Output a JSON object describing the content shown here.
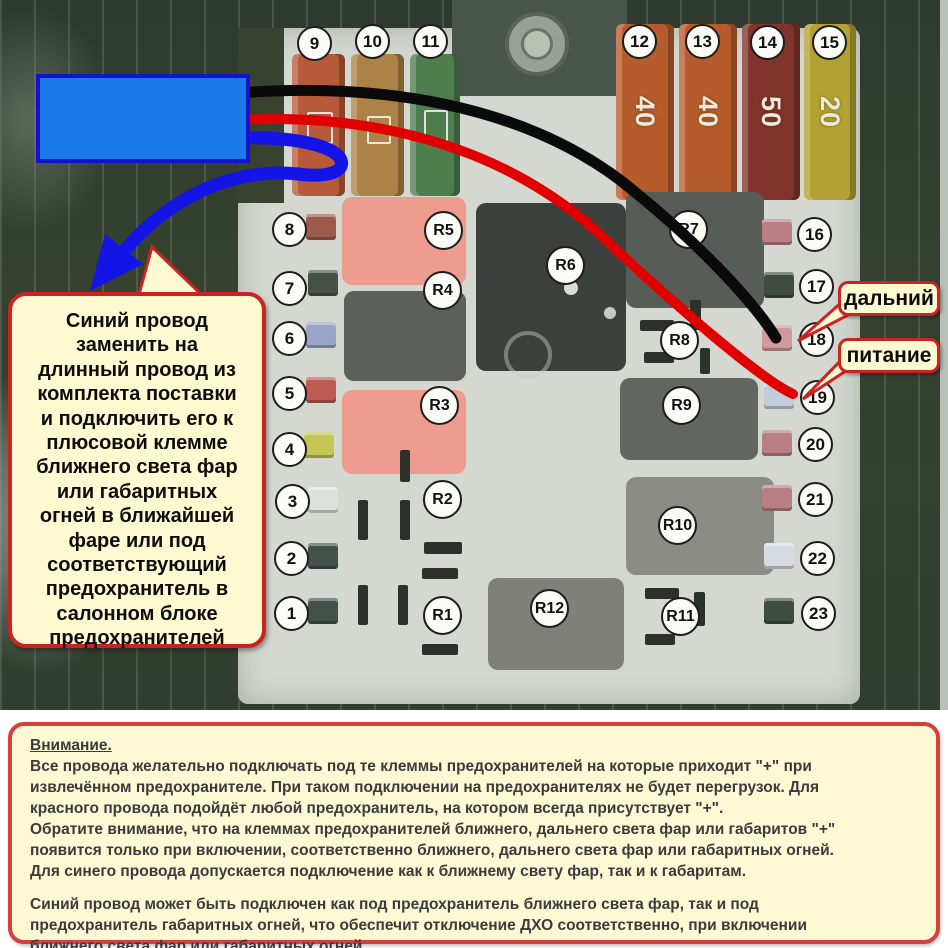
{
  "colors": {
    "wire_black": "#0a0a0a",
    "wire_red": "#e10000",
    "wire_blue": "#1414e6",
    "callout_bg": "#fdf9d0",
    "callout_border": "#cc2222",
    "blue_box_fill": "#1b79e8",
    "blue_box_border": "#1313cf"
  },
  "fusebox": {
    "fuse_numbers": [
      "1",
      "2",
      "3",
      "4",
      "5",
      "6",
      "7",
      "8",
      "9",
      "10",
      "11",
      "12",
      "13",
      "14",
      "15",
      "16",
      "17",
      "18",
      "19",
      "20",
      "21",
      "22",
      "23"
    ],
    "relay_labels": [
      "R1",
      "R2",
      "R3",
      "R4",
      "R5",
      "R6",
      "R7",
      "R8",
      "R9",
      "R10",
      "R11",
      "R12"
    ],
    "maxi_fuse_amps": [
      "40",
      "40",
      "50",
      "20"
    ]
  },
  "labels": {
    "high_beam": "дальний",
    "power": "питание"
  },
  "callout": {
    "lines": [
      "Синий провод",
      "заменить на",
      "длинный провод из",
      "комплекта поставки",
      "и подключить его к",
      "плюсовой клемме",
      "ближнего света фар",
      "или габаритных",
      "огней в ближайшей",
      "фаре или под",
      "соответствующий",
      "предохранитель в",
      "салонном блоке",
      "предохранителей"
    ]
  },
  "notice": {
    "title": "Внимание.",
    "para1_lines": [
      "Все провода желательно подключать под те клеммы предохранителей на которые приходит \"+\" при",
      "извлечённом предохранителе. При таком подключении на предохранителях не будет перегрузок. Для",
      "красного провода подойдёт любой предохранитель, на котором всегда присутствует \"+\".",
      "Обратите внимание, что на клеммах предохранителей ближнего, дальнего света фар или габаритов \"+\"",
      "появится только при включении, соответственно ближнего, дальнего света фар или габаритных огней.",
      "Для синего провода допускается подключение как к ближнему свету фар, так и к габаритам."
    ],
    "para2_lines": [
      "Синий провод может быть подключен как под предохранитель ближнего света фар, так и под",
      "предохранитель габаритных огней, что обеспечит отключение ДХО соответственно, при включении",
      "ближнего света фар или габаритных огней."
    ]
  }
}
